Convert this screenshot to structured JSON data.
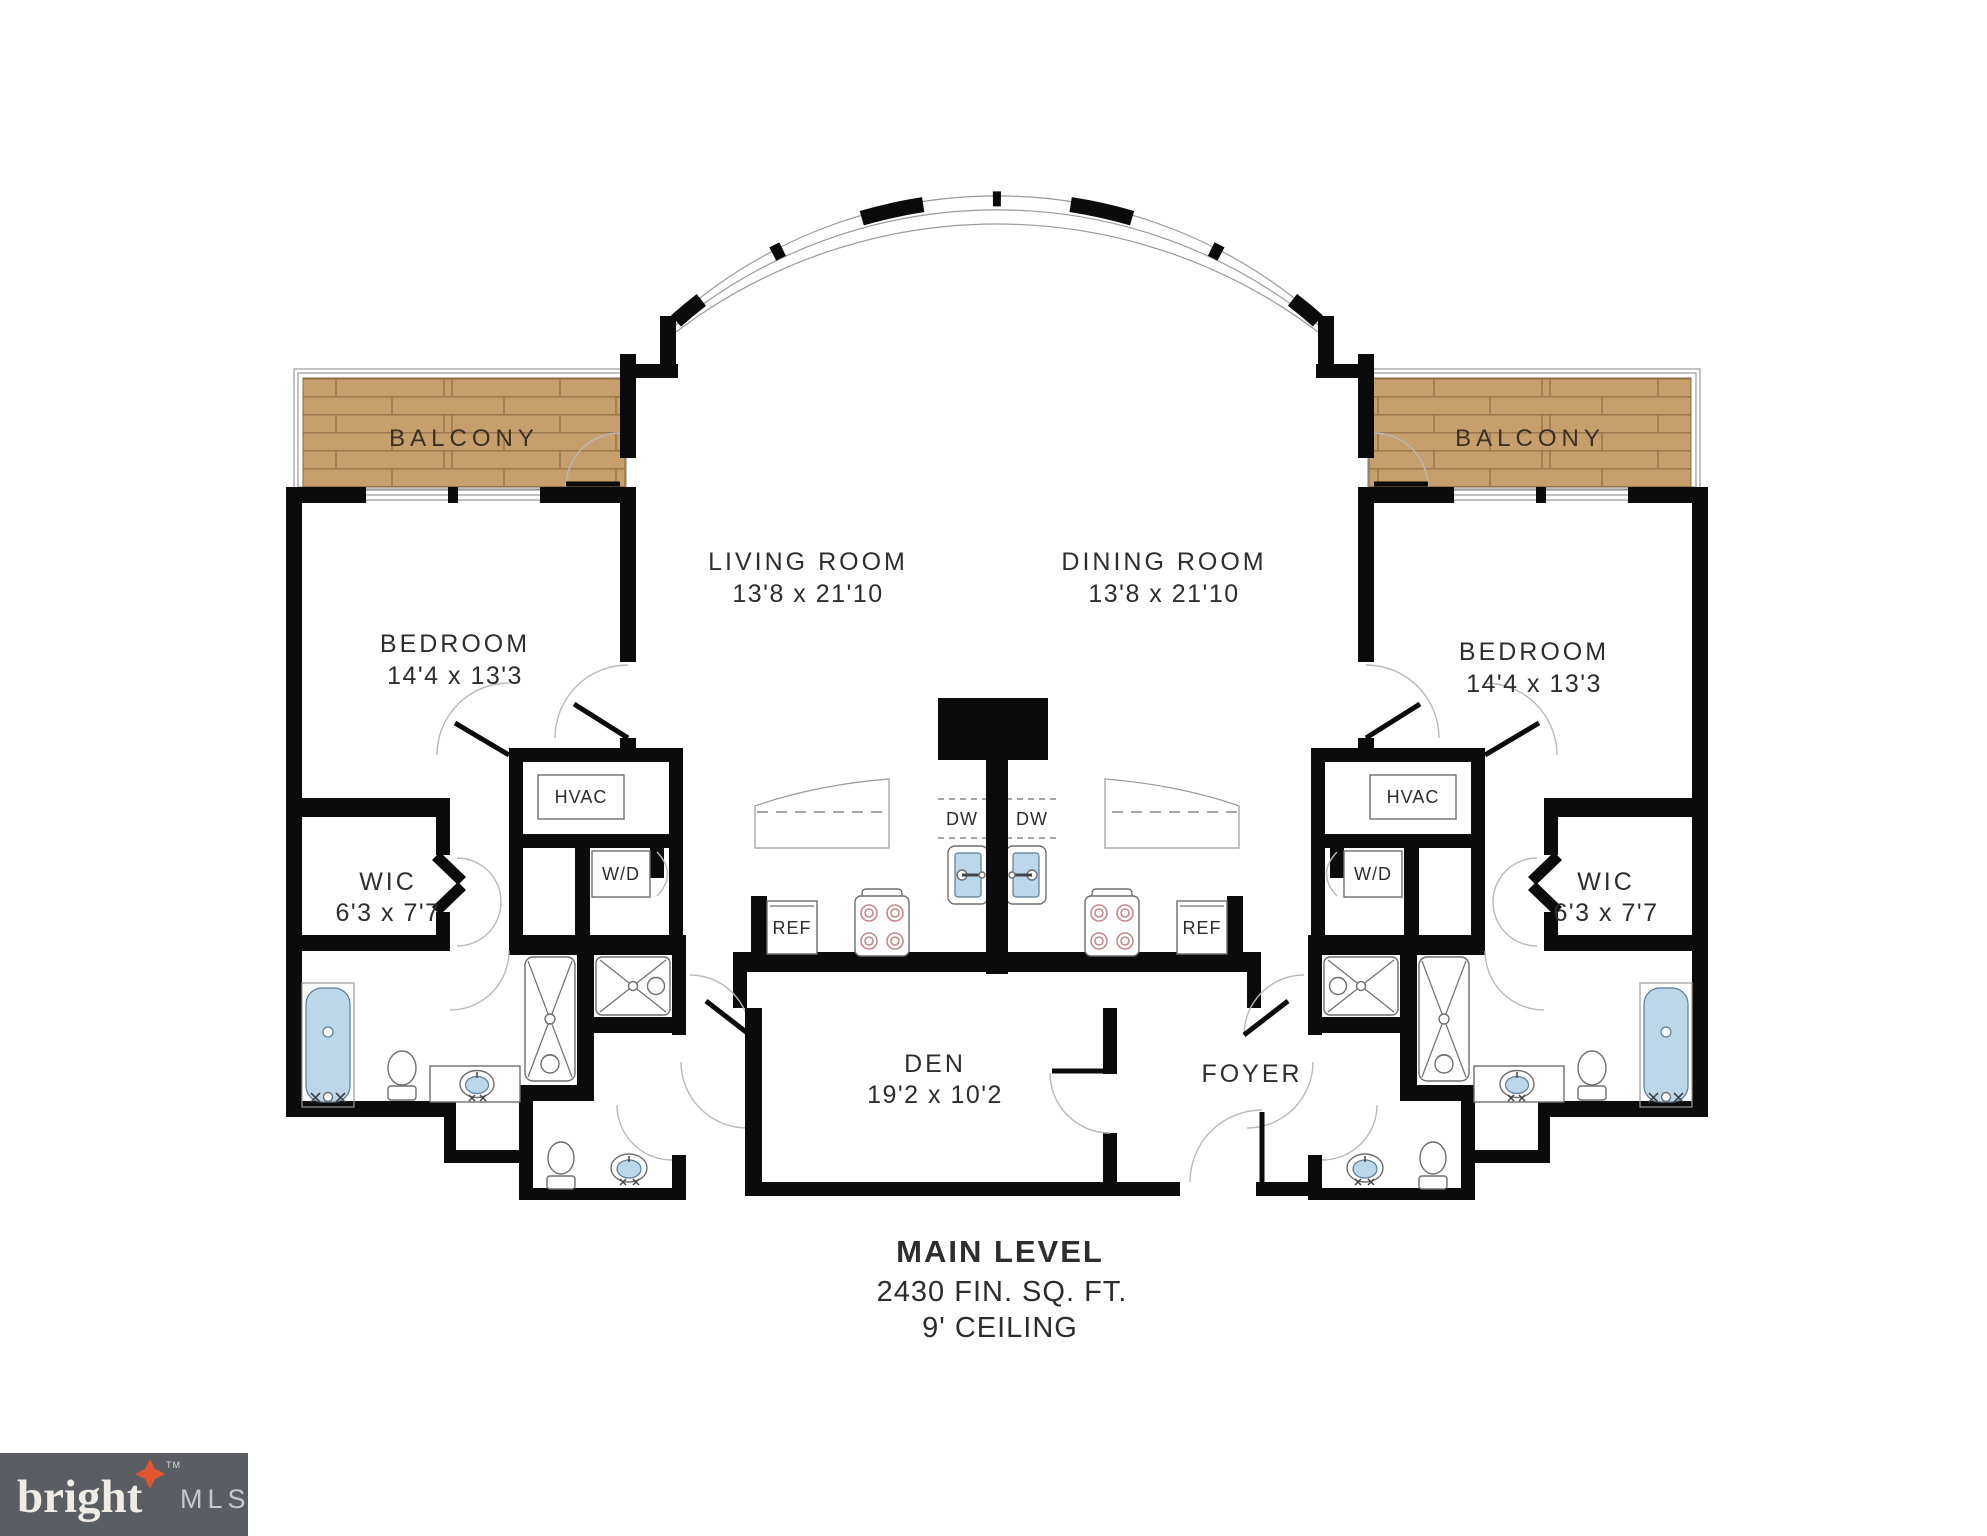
{
  "plan": {
    "rooms": {
      "balcony": "BALCONY",
      "living": {
        "name": "LIVING ROOM",
        "dims": "13'8 x 21'10"
      },
      "dining": {
        "name": "DINING ROOM",
        "dims": "13'8 x 21'10"
      },
      "bedroom": {
        "name": "BEDROOM",
        "dims": "14'4 x 13'3"
      },
      "wic": {
        "name": "WIC",
        "dims": "6'3 x 7'7"
      },
      "den": {
        "name": "DEN",
        "dims": "19'2 x 10'2"
      },
      "foyer": "FOYER"
    },
    "closets": {
      "hvac": "HVAC",
      "wd": "W/D"
    },
    "appliances": {
      "dw": "DW",
      "ref": "REF"
    },
    "footer": {
      "title": "MAIN LEVEL",
      "area": "2430 FIN. SQ. FT.",
      "ceiling": "9' CEILING"
    },
    "colors": {
      "wall": "#0B0B0B",
      "wood": "#C5A06C",
      "wood_seam": "#97734A",
      "fixture_blue": "#BCD7EA",
      "logo_bg": "#5A5E63",
      "logo_star": "#E0552F"
    }
  },
  "logo": {
    "brand": "bright",
    "suffix": "MLS",
    "tm": "TM"
  }
}
